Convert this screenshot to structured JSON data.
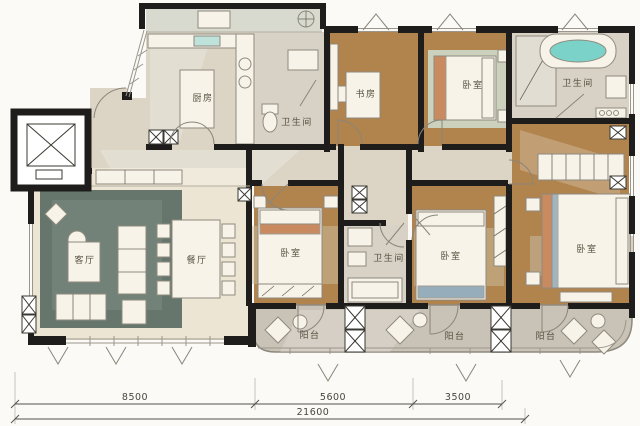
{
  "plan": {
    "rooms": {
      "kitchen": {
        "label": "厨房"
      },
      "bath_top_left": {
        "label": "卫生间"
      },
      "study": {
        "label": "书房"
      },
      "bedroom_top": {
        "label": "卧室"
      },
      "bath_top_right": {
        "label": "卫生间"
      },
      "living_room": {
        "label": "客厅"
      },
      "dining_room": {
        "label": "餐厅"
      },
      "bedroom_left": {
        "label": "卧室"
      },
      "bath_middle": {
        "label": "卫生间"
      },
      "bedroom_middle": {
        "label": "卧室"
      },
      "bedroom_master": {
        "label": "卧室"
      },
      "balcony_left": {
        "label": "阳台"
      },
      "balcony_middle": {
        "label": "阳台"
      },
      "balcony_right": {
        "label": "阳台"
      }
    },
    "dimensions": {
      "segment_1": "8500",
      "segment_2": "5600",
      "segment_3": "3500",
      "total": "21600"
    },
    "colors": {
      "wall": "#1e1d1b",
      "wood_floor": "#b1834d",
      "marble_floor": "#dcd5c6",
      "cream_floor": "#ece5d3",
      "bath_floor": "#d8d2c6",
      "balcony_floor": "#c9c2b6",
      "service_floor": "#d8dacf",
      "rug": "#50635a",
      "bathtub_water": "#7bd2c8",
      "furniture": "#f7f3e8",
      "accent_orange": "#c0703f",
      "accent_blue": "#7e9cb0"
    }
  }
}
